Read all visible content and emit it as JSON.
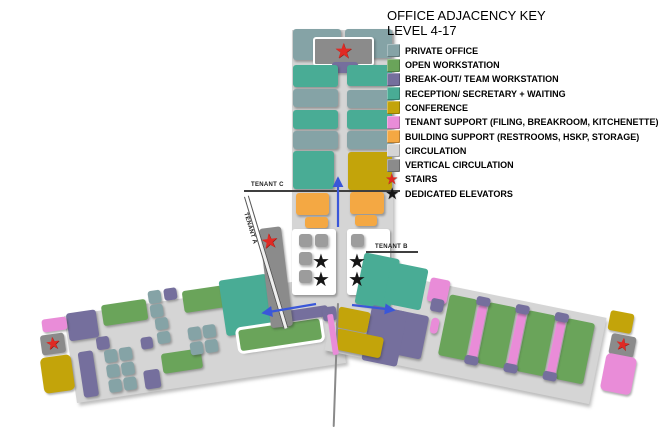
{
  "legend": {
    "title": "OFFICE ADJACENCY KEY",
    "subtitle": "LEVEL 4-17",
    "items": [
      {
        "label": "PRIVATE OFFICE",
        "type": "swatch",
        "color_key": "po"
      },
      {
        "label": "OPEN WORKSTATION",
        "type": "swatch",
        "color_key": "ow"
      },
      {
        "label": "BREAK-OUT/ TEAM WORKSTATION",
        "type": "swatch",
        "color_key": "bo"
      },
      {
        "label": "RECEPTION/ SECRETARY + WAITING",
        "type": "swatch",
        "color_key": "rc"
      },
      {
        "label": "CONFERENCE",
        "type": "swatch",
        "color_key": "cf"
      },
      {
        "label": "TENANT SUPPORT (FILING, BREAKROOM, KITCHENETTE)",
        "type": "swatch",
        "color_key": "ts"
      },
      {
        "label": "BUILDING SUPPORT (RESTROOMS, HSKP, STORAGE)",
        "type": "swatch",
        "color_key": "bs"
      },
      {
        "label": "CIRCULATION",
        "type": "swatch",
        "color_key": "cir"
      },
      {
        "label": "VERTICAL CIRCULATION",
        "type": "swatch",
        "color_key": "vc"
      },
      {
        "label": "STAIRS",
        "type": "star",
        "color_key": "red"
      },
      {
        "label": "DEDICATED ELEVATORS",
        "type": "star",
        "color_key": "blk"
      }
    ]
  },
  "plan": {
    "labels": {
      "tenant_a": "TENANT A",
      "tenant_b": "TENANT B",
      "tenant_c": "TENANT C"
    },
    "colors": {
      "po": "#85a3a6",
      "ow": "#6aa45a",
      "bo": "#756f9d",
      "rc": "#49ac95",
      "cf": "#c3a40a",
      "ts": "#e98cd8",
      "bs": "#f4a843",
      "cir": "#d5d5d5",
      "vc": "#8b8b8b",
      "sq": "#9c9c9c",
      "red": "#e02a24",
      "blk": "#161616",
      "arrow": "#3a57d9"
    }
  },
  "icons": {
    "star": "★"
  }
}
